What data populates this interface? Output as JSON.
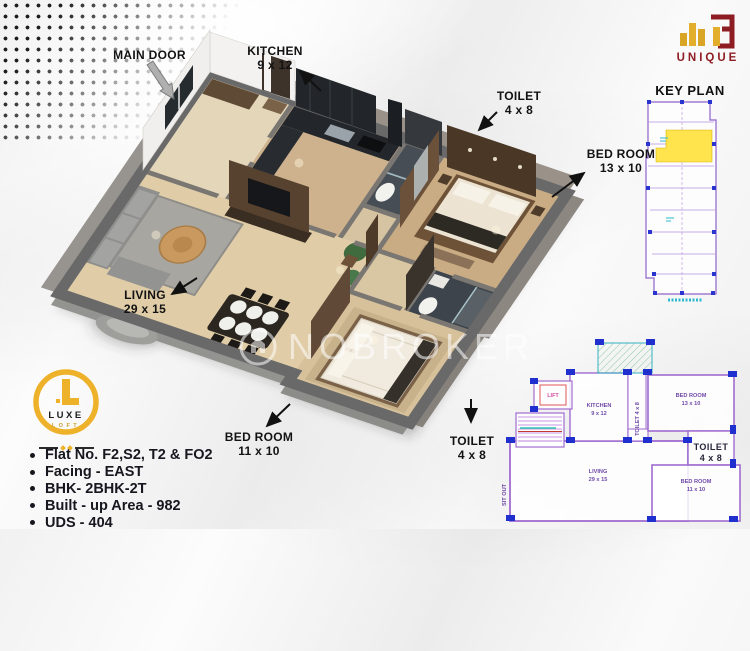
{
  "annotations": {
    "main_door": {
      "label": "MAIN DOOR"
    },
    "kitchen": {
      "label": "KITCHEN",
      "size": "9 x 12"
    },
    "toilet_top": {
      "label": "TOILET",
      "size": "4 x 8"
    },
    "bedroom_right": {
      "label": "BED ROOM",
      "size": "13 x 10"
    },
    "living": {
      "label": "LIVING",
      "size": "29 x 15"
    },
    "bedroom_bottom": {
      "label": "BED ROOM",
      "size": "11 x 10"
    },
    "toilet_bottom": {
      "label": "TOILET",
      "size": "4 x 8"
    }
  },
  "key_plan": {
    "title": "KEY PLAN"
  },
  "brand_unique": {
    "name": "UNIQUE"
  },
  "brand_luxe": {
    "line1": "LUXE",
    "line2": "LOFT"
  },
  "watermark": {
    "text": "NOBROKER"
  },
  "details": {
    "items": [
      "Flat No. F2,S2, T2 & FO2",
      "Facing - EAST",
      "BHK- 2BHK-2T",
      "Built - up Area - 982",
      "UDS - 404"
    ]
  },
  "cad_plan": {
    "kitchen": {
      "name": "KITCHEN",
      "size": "9 x 12"
    },
    "toilet_small": {
      "name": "TOILET 4 x 8"
    },
    "bedroom_right": {
      "name": "BED ROOM",
      "size": "13 x 10"
    },
    "toilet_big": {
      "name": "TOILET",
      "size": "4 x 8"
    },
    "living": {
      "name": "LIVING",
      "size": "29 x 15"
    },
    "bedroom_bottom": {
      "name": "BED ROOM",
      "size": "11 x 10"
    },
    "lift": {
      "name": "LIFT"
    },
    "sitout": {
      "name": "SIT OUT"
    }
  },
  "colors": {
    "accent_gold": "#eeb22a",
    "brand_red": "#8e1d23",
    "cad_purple": "#a06cd0",
    "highlight_yellow": "#ffe44d",
    "wall_gray": "#6b6b6b"
  }
}
